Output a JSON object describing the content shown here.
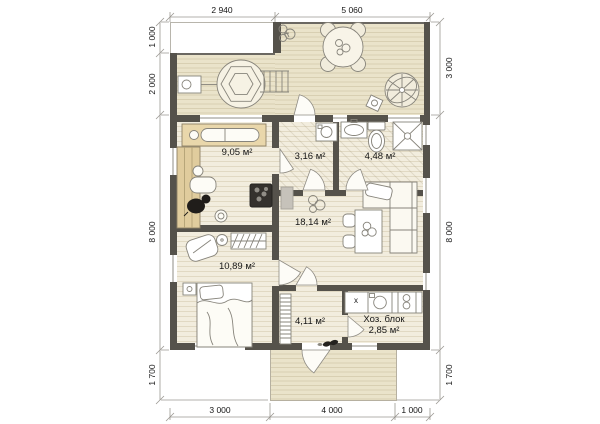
{
  "colors": {
    "wall": "#55524b",
    "deck": "#eae3ca",
    "deck-line": "#d8cfb2",
    "floor": "#f2edde",
    "floor-line": "#e1d9c3",
    "sauna-wood": "#e0cc9d",
    "bench-wood": "#e9d7ab",
    "outline": "#87847b",
    "dim-line": "#9b9892",
    "window-line": "#8f8c84",
    "text": "#161616"
  },
  "plan": {
    "rooms": [
      {
        "id": "sauna",
        "area": "9,05 м²"
      },
      {
        "id": "vestibule",
        "area": "3,16 м²"
      },
      {
        "id": "bathroom",
        "area": "4,48 м²"
      },
      {
        "id": "living",
        "area": "18,14 м²"
      },
      {
        "id": "bedroom",
        "area": "10,89 м²"
      },
      {
        "id": "hall",
        "area": "4,11 м²"
      },
      {
        "id": "utility",
        "name": "Хоз. блок",
        "area": "2,85 м²"
      }
    ],
    "utility_counter_mark": "x",
    "dimensions": {
      "top": [
        "2 940",
        "5 060"
      ],
      "bottom": [
        "3 000",
        "4 000",
        "1 000"
      ],
      "left": [
        "1 000",
        "2 000",
        "8 000",
        "1 700"
      ],
      "right": [
        "3 000",
        "8 000",
        "1 700"
      ]
    }
  }
}
